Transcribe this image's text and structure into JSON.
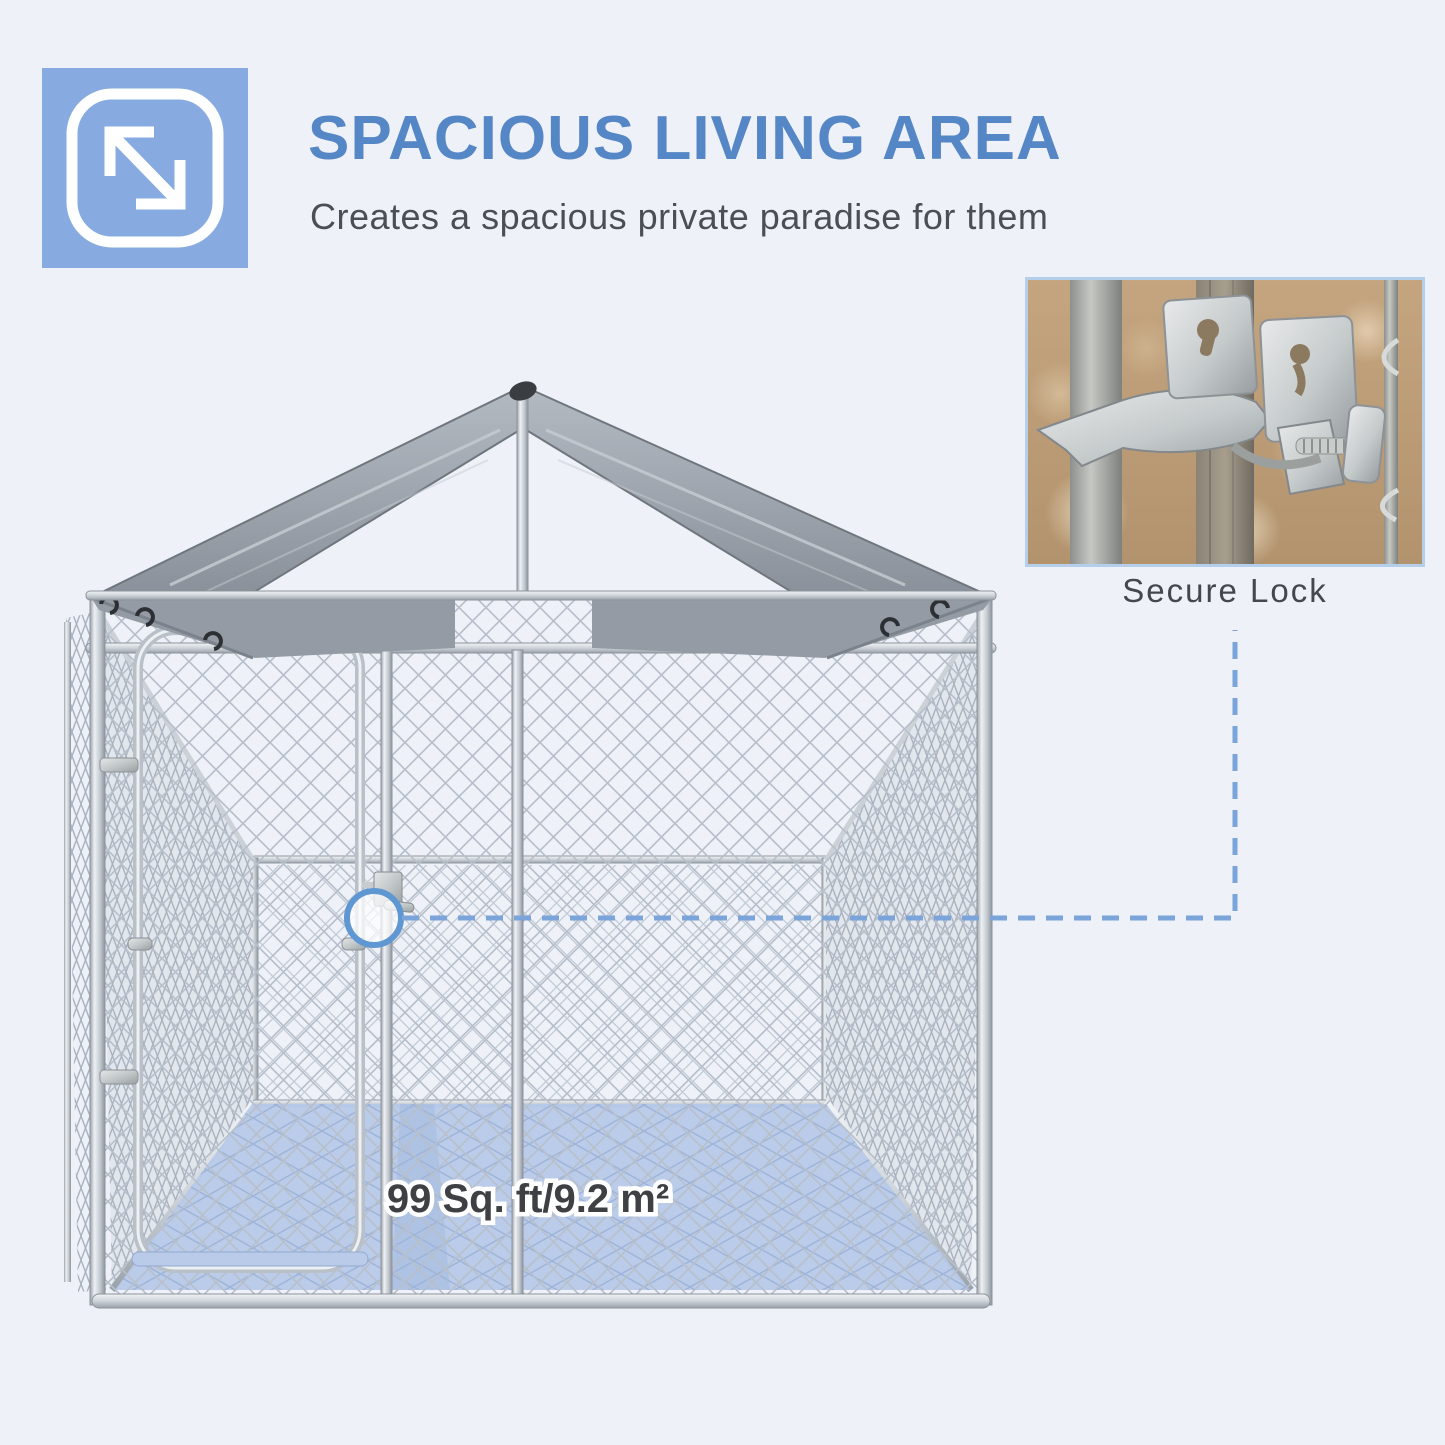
{
  "theme": {
    "page-bg": "#eef1f8",
    "badge": "#87abe1",
    "title": "#5586c5",
    "subtitle": "#4b4f55",
    "accent": "#7ba4da",
    "circle": "#5f97d3",
    "floor-fill": "#b6c9e9",
    "floor-text": "#3e4043",
    "caption": "#44484d"
  },
  "header": {
    "icon": "expand-arrows-icon",
    "title": "SPACIOUS LIVING AREA",
    "subtitle": "Creates a spacious private paradise for them"
  },
  "kennel": {
    "floor_label": "99 Sq. ft/9.2 m²",
    "structure": "chain-link dog kennel with gray peaked canopy roof and arched mesh door"
  },
  "callout": {
    "caption": "Secure Lock",
    "style": "blue dashed leader line from circled door latch to inset photo"
  }
}
